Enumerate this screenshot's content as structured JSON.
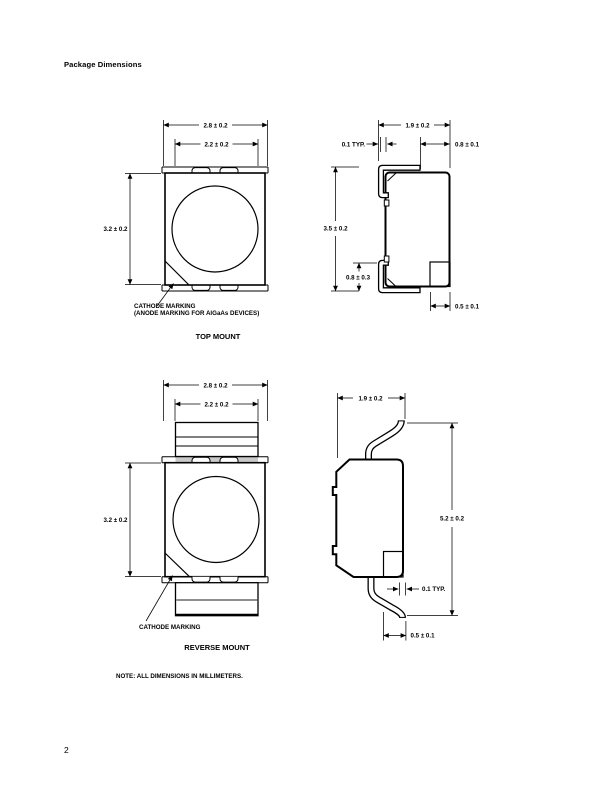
{
  "page": {
    "title": "Package Dimensions",
    "note": "NOTE: ALL DIMENSIONS IN MILLIMETERS.",
    "page_number": "2"
  },
  "top_mount": {
    "caption": "TOP MOUNT",
    "cathode_label_line1": "CATHODE MARKING",
    "cathode_label_line2": "(ANODE MARKING FOR AlGaAs DEVICES)",
    "front": {
      "outer_width": "2.8 ± 0.2",
      "inner_width": "2.2 ± 0.2",
      "height": "3.2 ± 0.2"
    },
    "side": {
      "width": "1.9 ± 0.2",
      "lead_thickness": "0.1 TYP.",
      "lead_top_width": "0.8 ± 0.1",
      "height": "3.5 ± 0.2",
      "lead_height": "0.8 ± 0.3",
      "lead_foot_width": "0.5 ± 0.1"
    }
  },
  "reverse_mount": {
    "caption": "REVERSE MOUNT",
    "cathode_label": "CATHODE MARKING",
    "front": {
      "outer_width": "2.8 ± 0.2",
      "inner_width": "2.2 ± 0.2",
      "height": "3.2 ± 0.2"
    },
    "side": {
      "width": "1.9 ± 0.2",
      "height": "5.2 ± 0.2",
      "lead_thickness": "0.1 TYP.",
      "lead_foot_width": "0.5 ± 0.1"
    }
  }
}
